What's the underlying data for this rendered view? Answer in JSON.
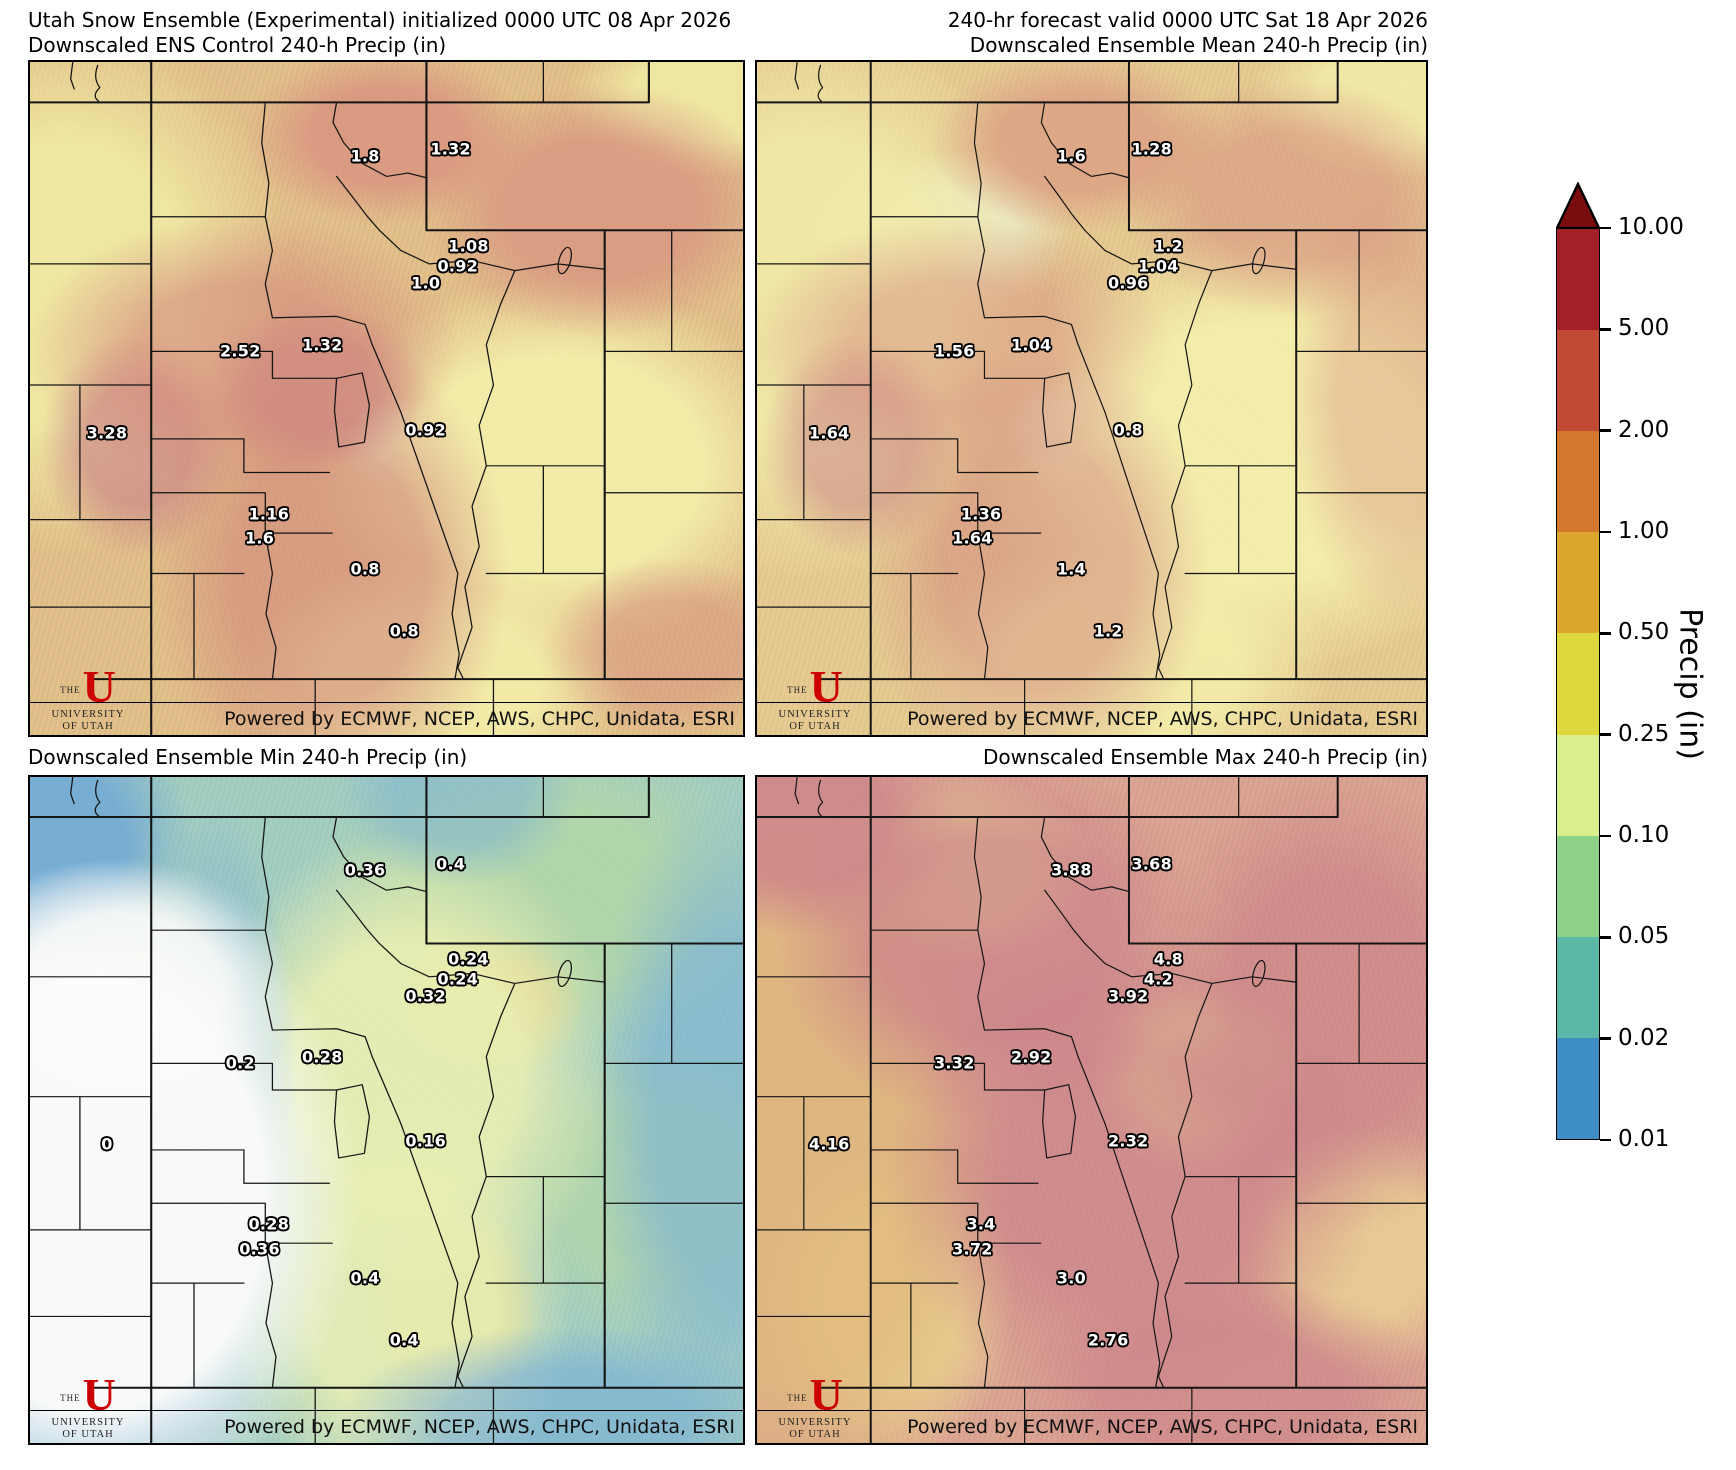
{
  "figure": {
    "background": "#ffffff"
  },
  "panels": [
    {
      "id": "ens-control",
      "title_lines": [
        "Utah Snow Ensemble (Experimental) initialized 0000 UTC 08 Apr 2026",
        "Downscaled ENS Control 240-h Precip (in)"
      ],
      "footer": "Powered by ECMWF, NCEP, AWS, CHPC, Unidata, ESRI",
      "values": [
        "1.8",
        "1.32",
        "1.08",
        "0.92",
        "1.0",
        "2.52",
        "1.32",
        "3.28",
        "0.92",
        "1.16",
        "1.6",
        "0.8",
        "0.8"
      ]
    },
    {
      "id": "ens-mean",
      "title_lines": [
        "240-hr forecast valid 0000 UTC Sat 18 Apr 2026",
        "Downscaled Ensemble Mean 240-h Precip (in)"
      ],
      "footer": "Powered by ECMWF, NCEP, AWS, CHPC, Unidata, ESRI",
      "values": [
        "1.6",
        "1.28",
        "1.2",
        "1.04",
        "0.96",
        "1.56",
        "1.04",
        "1.64",
        "0.8",
        "1.36",
        "1.64",
        "1.4",
        "1.2"
      ]
    },
    {
      "id": "ens-min",
      "title_lines": [
        "Downscaled Ensemble Min 240-h Precip (in)"
      ],
      "footer": "Powered by ECMWF, NCEP, AWS, CHPC, Unidata, ESRI",
      "values": [
        "0.36",
        "0.4",
        "0.24",
        "0.24",
        "0.32",
        "0.2",
        "0.28",
        "0",
        "0.16",
        "0.28",
        "0.36",
        "0.4",
        "0.4"
      ]
    },
    {
      "id": "ens-max",
      "title_lines": [
        "Downscaled Ensemble Max 240-h Precip (in)"
      ],
      "footer": "Powered by ECMWF, NCEP, AWS, CHPC, Unidata, ESRI",
      "values": [
        "3.88",
        "3.68",
        "4.8",
        "4.2",
        "3.92",
        "3.32",
        "2.92",
        "4.16",
        "2.32",
        "3.4",
        "3.72",
        "3.0",
        "2.76"
      ]
    }
  ],
  "value_positions": [
    {
      "x": 47.0,
      "y": 14.0
    },
    {
      "x": 59.0,
      "y": 13.0
    },
    {
      "x": 61.5,
      "y": 27.3
    },
    {
      "x": 60.0,
      "y": 30.3
    },
    {
      "x": 55.5,
      "y": 32.9
    },
    {
      "x": 29.5,
      "y": 43.0
    },
    {
      "x": 41.0,
      "y": 42.0
    },
    {
      "x": 10.8,
      "y": 55.1
    },
    {
      "x": 55.5,
      "y": 54.7
    },
    {
      "x": 33.5,
      "y": 67.1
    },
    {
      "x": 32.2,
      "y": 70.8
    },
    {
      "x": 47.0,
      "y": 75.3
    },
    {
      "x": 52.5,
      "y": 84.6
    }
  ],
  "logo": {
    "line1": "THE",
    "letter": "U",
    "line2": "UNIVERSITY",
    "line3": "OF UTAH",
    "color": "#cc0000"
  },
  "colorbar": {
    "label": "Precip (in)",
    "ticks": [
      "10.00",
      "5.00",
      "2.00",
      "1.00",
      "0.50",
      "0.25",
      "0.10",
      "0.05",
      "0.02",
      "0.01"
    ],
    "segment_colors": [
      "#a32026",
      "#c14a34",
      "#d3772f",
      "#dda62d",
      "#ded83e",
      "#d9ee8c",
      "#8ed189",
      "#5cb8a6",
      "#3e8ec4"
    ],
    "arrow_color": "#7a0c10",
    "border_color": "#000000"
  }
}
